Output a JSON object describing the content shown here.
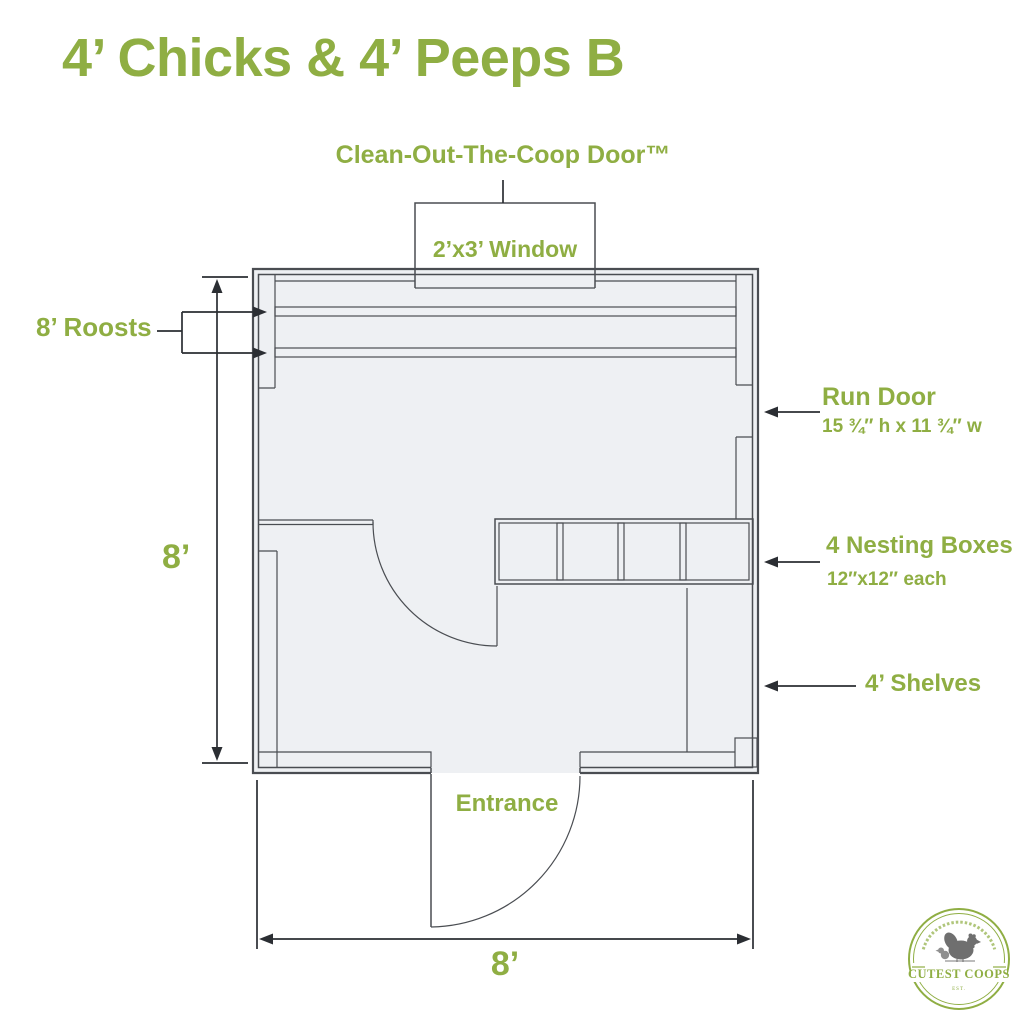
{
  "title": "4’ Chicks & 4’ Peeps B",
  "labels": {
    "cleanout_door": "Clean-Out-The-Coop Door™",
    "window": "2’x3’ Window",
    "roosts": "8’ Roosts",
    "run_door": "Run Door",
    "run_door_size": "15 ¾″ h x 11 ¾″ w",
    "nesting_boxes": "4 Nesting Boxes",
    "nesting_boxes_size": "12″x12″ each",
    "shelves": "4’ Shelves",
    "entrance": "Entrance",
    "dim_width": "8’",
    "dim_height": "8’"
  },
  "logo": {
    "name": "CUTEST COOPS",
    "est": "EST."
  },
  "colors": {
    "green": "#8fae43",
    "wall": "#4a4d52",
    "dims": "#2b2e33",
    "floor_fill": "#eef0f3"
  }
}
